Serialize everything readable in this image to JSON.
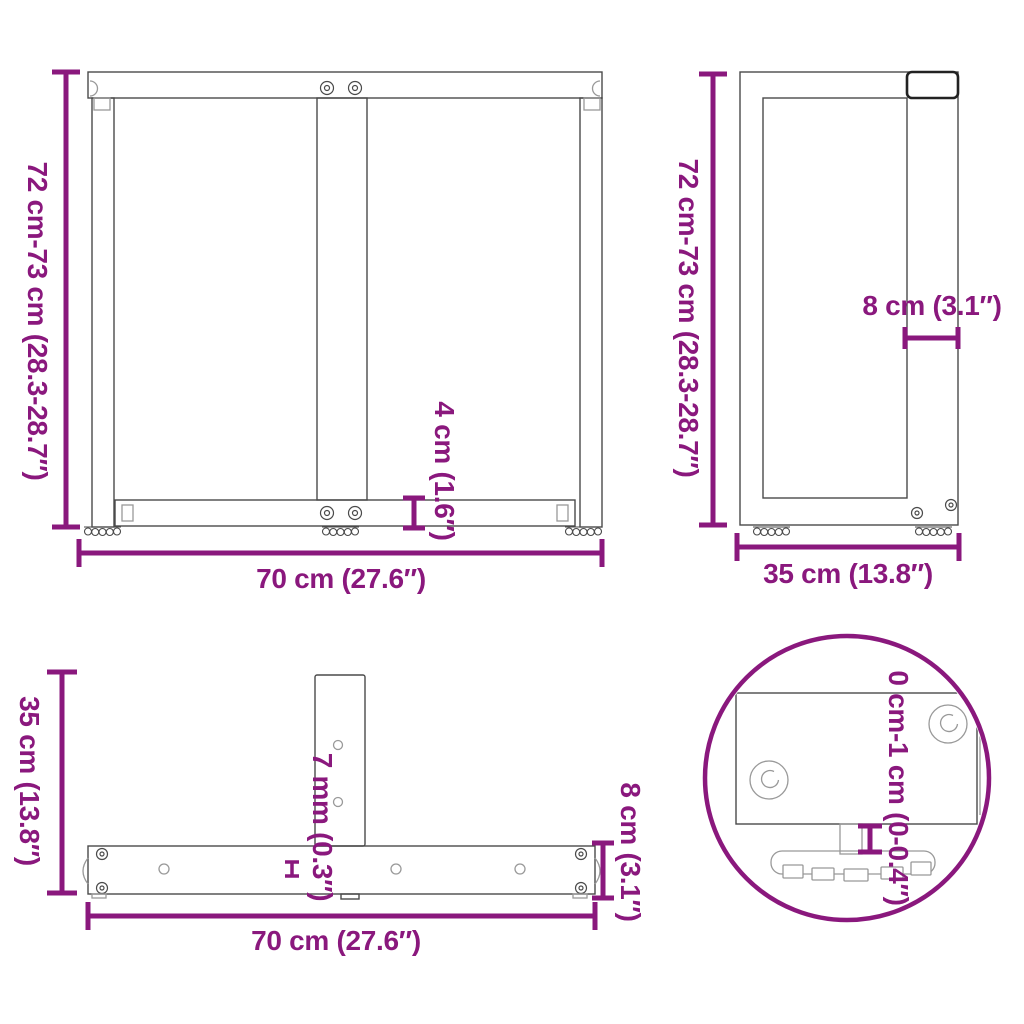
{
  "colors": {
    "accent": "#8A187D",
    "line": "#4a4a4a",
    "line_light": "#999999",
    "cap_dark": "#222222",
    "background": "#ffffff"
  },
  "views": {
    "front": {
      "height": "72 cm-73 cm (28.3-28.7″)",
      "width": "70 cm (27.6″)",
      "crossbar_height": "4 cm (1.6″)"
    },
    "side": {
      "height": "72 cm-73 cm (28.3-28.7″)",
      "depth": "35 cm (13.8″)",
      "leg_width": "8 cm (3.1″)"
    },
    "top": {
      "depth": "35 cm (13.8″)",
      "width": "70 cm (27.6″)",
      "plate_thickness": "7 mm (0.3″)",
      "leg_depth": "8 cm (3.1″)"
    },
    "foot_detail": {
      "height_adjustment": "0 cm-1 cm (0-0.4″)"
    }
  }
}
